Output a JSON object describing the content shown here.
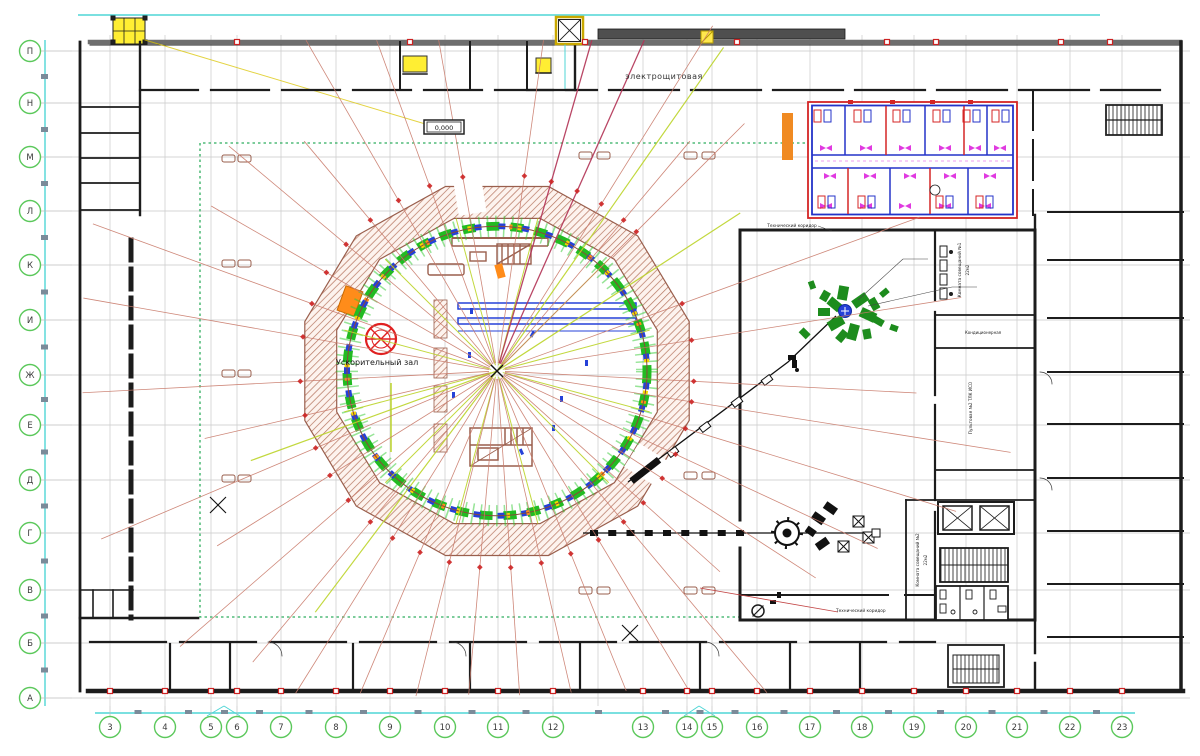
{
  "drawing": {
    "labels": {
      "electrical_room": "электрощитовая",
      "elevation": "0,000",
      "accelerator_hall": "Ускорительный зал",
      "tech_corridor": "Технический коридор",
      "meeting_room_1": "Комната совещаний №1",
      "meeting_room_1_area": "22м2",
      "meeting_room_2": "Комната совещаний №2",
      "meeting_room_2_area": "22м2",
      "conditioning_room": "Кондиционерная",
      "control_room": "Пультовая №2 ТЛК ИСО"
    },
    "axes": {
      "rows": [
        "П",
        "Н",
        "М",
        "Л",
        "К",
        "И",
        "Ж",
        "Е",
        "Д",
        "Г",
        "В",
        "Б",
        "А"
      ],
      "columns": [
        "3",
        "4",
        "5",
        "6",
        "7",
        "8",
        "9",
        "10",
        "11",
        "12",
        "13",
        "14",
        "15",
        "16",
        "17",
        "18",
        "19",
        "20",
        "21",
        "22",
        "23"
      ]
    },
    "colors": {
      "axis_bubble": "#5bc85b",
      "axis_text": "#3a3a3a",
      "dimension_line": "#4fd6d6",
      "grid_line": "#c9c9c9",
      "wall": "#1c1c1c",
      "ring_wall": "#9a5f4d",
      "magnet_green": "#2fca2f",
      "magnet_blue": "#2541d8",
      "magnet_yellow": "#f5d800",
      "magnet_orange": "#ff8c1a",
      "survey_line_red": "#c97b6b",
      "survey_line_dark_red": "#b23355",
      "survey_marker_red": "#cc2222",
      "center_line_lime": "#bcd42a",
      "boundary_green_dotted": "#2fae5f",
      "office_red": "#d42525",
      "office_blue": "#2433c8",
      "office_magenta": "#e03ae0",
      "equipment_green": "#1d8c1d",
      "highlight_orange": "#f08a22"
    }
  }
}
